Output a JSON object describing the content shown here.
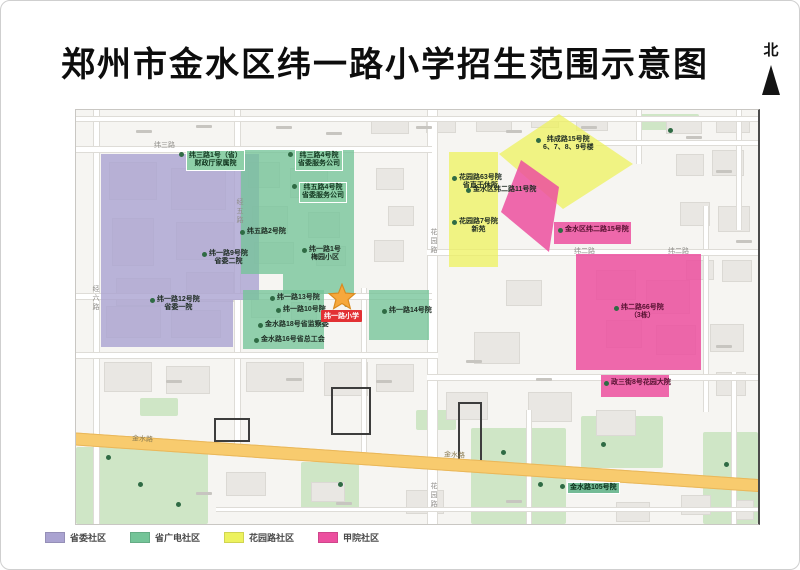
{
  "title": "郑州市金水区纬一路小学招生范围示意图",
  "north": {
    "label": "北"
  },
  "school": {
    "label": "纬一路小学",
    "label_bg": "#e23134",
    "star_color": "#f6a83c",
    "star_edge": "#d98a1f"
  },
  "legend": [
    {
      "name": "省委社区",
      "color": "#aaa3d1"
    },
    {
      "name": "省广电社区",
      "color": "#74c498"
    },
    {
      "name": "花园路社区",
      "color": "#edf25e"
    },
    {
      "name": "甲院社区",
      "color": "#ec4f9f"
    }
  ],
  "roads": {
    "weisan": "纬三路",
    "weier": "纬二路",
    "huayuan": "花园路",
    "jinshui": "金水路",
    "jingwu": "经五路",
    "jingliu": "经六路",
    "jinshui_color": "#f8cb6e"
  },
  "map_labels": [
    {
      "lines": [
        "纬三路1号（省）",
        "财政厅家属院"
      ]
    },
    {
      "lines": [
        "纬三路4号院",
        "省委服务公司"
      ]
    },
    {
      "lines": [
        "纬五路4号院",
        "省委服务公司"
      ]
    },
    {
      "lines": [
        "纬五路2号院"
      ]
    },
    {
      "lines": [
        "纬一路1号",
        "梅园小区"
      ]
    },
    {
      "lines": [
        "纬一路9号院",
        "省委二院"
      ]
    },
    {
      "lines": [
        "纬一路12号院",
        "省委一院"
      ]
    },
    {
      "lines": [
        "纬一路13号院"
      ]
    },
    {
      "lines": [
        "纬一路10号院"
      ]
    },
    {
      "lines": [
        "金水路18号省监察委"
      ]
    },
    {
      "lines": [
        "金水路16号省总工会"
      ]
    },
    {
      "lines": [
        "纬一路14号院"
      ]
    },
    {
      "lines": [
        "花园路63号院",
        "省直干休所"
      ]
    },
    {
      "lines": [
        "花园路7号院",
        "新苑"
      ]
    },
    {
      "lines": [
        "纬成路15号院",
        "6、7、8、9号楼"
      ]
    },
    {
      "lines": [
        "金水区纬二路11号院"
      ]
    },
    {
      "lines": [
        "金水区纬二路15号院"
      ]
    },
    {
      "lines": [
        "纬二路66号院",
        "（3栋）"
      ]
    },
    {
      "lines": [
        "政三街8号花园大院"
      ]
    },
    {
      "lines": [
        "金水路105号院"
      ]
    }
  ]
}
